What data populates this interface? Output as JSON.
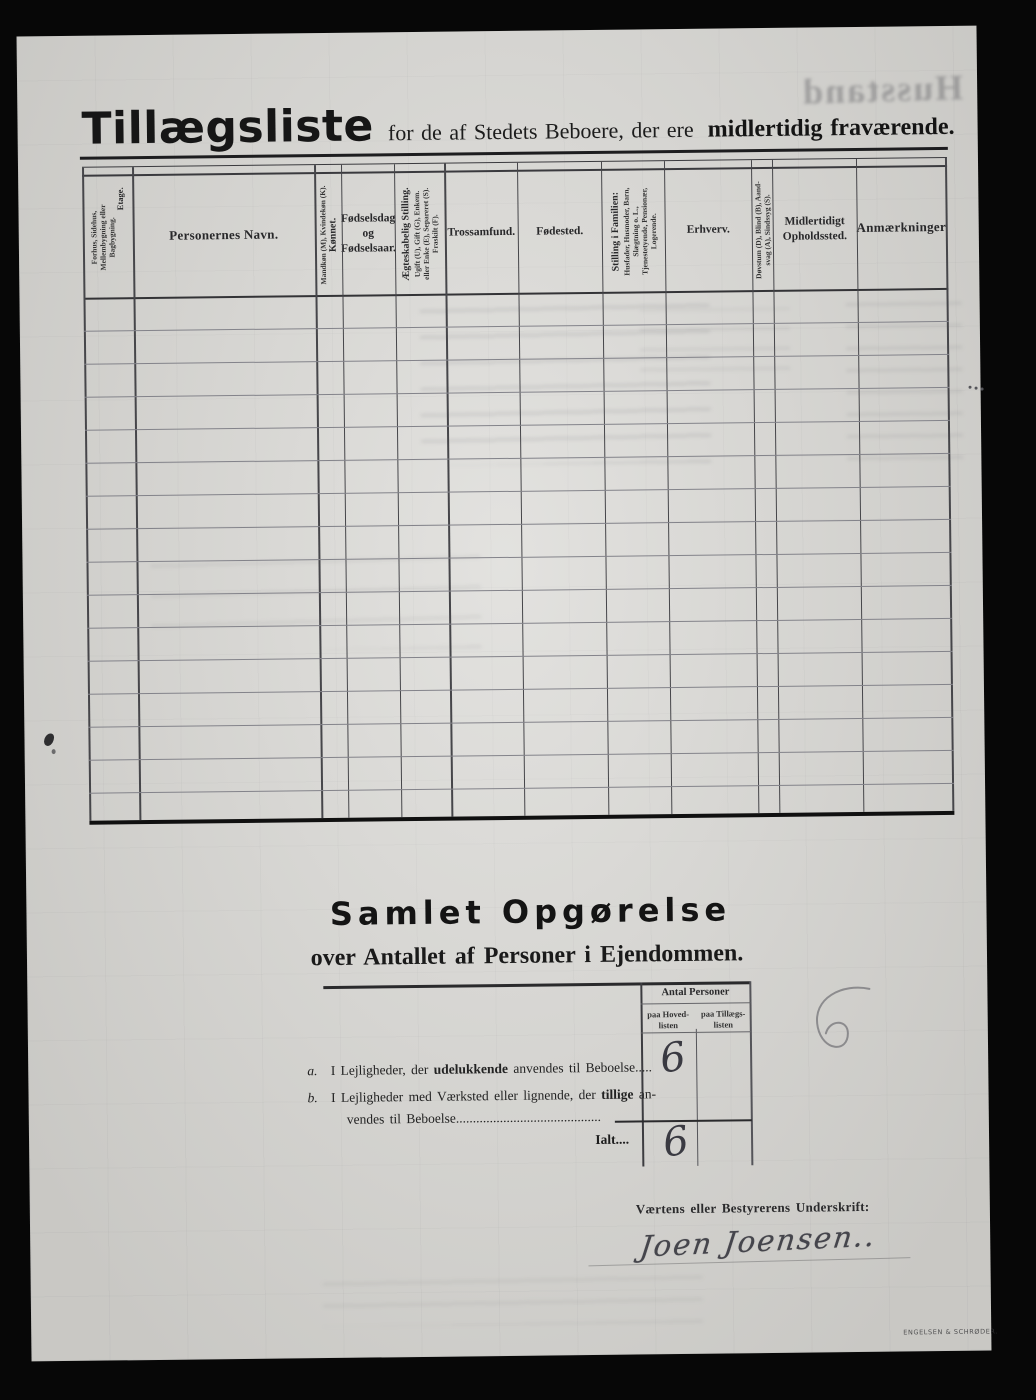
{
  "page": {
    "title_main": "Tillægsliste",
    "title_mid": "for de af Stedets Beboere, der ere",
    "title_bold": "midlertidig fraværende."
  },
  "table": {
    "body_rows": 16,
    "columns": [
      {
        "sub": "Forhus, Sidehus,\nMellembygning eller\nBagbygning.",
        "title": "Etage."
      },
      {
        "label": "Personernes Navn."
      },
      {
        "sub": "Mandkøn (M), Kvindekøn (K).",
        "title": "Kønnet."
      },
      {
        "label": "Fødselsdag\nog\nFødselsaar."
      },
      {
        "title": "Ægteskabelig Stilling.",
        "sub": "Ugift (U), Gift (G), Enkem.\neller Enke (E), Separeret (S).\nFraskilt (F)."
      },
      {
        "label": "Trossamfund."
      },
      {
        "label": "Fødested."
      },
      {
        "title": "Stilling i Familien:",
        "sub": "Husfader, Husmoder, Barn,\nSlægtning o. L.,\nTjenestetyende, Pensionær,\nLogerende."
      },
      {
        "label": "Erhverv."
      },
      {
        "sub": "Døvstum (D), Blind (B), Aand-\nsvag (A), Sindssyg (S)."
      },
      {
        "label": "Midlertidigt\nOpholdssted."
      },
      {
        "label": "Anmærkninger"
      }
    ]
  },
  "summary": {
    "title": "Samlet Opgørelse",
    "subtitle": "over Antallet af Personer i Ejendommen.",
    "count_header": "Antal Personer",
    "count_col1": "paa Hoved-\nlisten",
    "count_col2": "paa Tillægs-\nlisten",
    "row_a": {
      "prefix": "a.",
      "text1": "I Lejligheder, der",
      "bold": "udelukkende",
      "text2": "anvendes til Beboelse",
      "dots": ".....",
      "value_hoved": "6"
    },
    "row_b": {
      "prefix": "b.",
      "text1": "I Lejligheder med Værksted eller lignende, der",
      "bold": "tillige",
      "text2": "an-",
      "line2": "vendes til Beboelse",
      "dots": "..........................................."
    },
    "total": {
      "label": "Ialt",
      "dots": "....",
      "value_hoved": "6"
    }
  },
  "signature": {
    "label": "Værtens eller Bestyrerens Underskrift:",
    "name": "Joen Joensen.."
  },
  "footer": {
    "printer": "ENGELSEN & SCHRØDER."
  },
  "ghost": {
    "top_right": "Husstand"
  },
  "colors": {
    "paper": "#d8d7d3",
    "ink": "#1c1c1c",
    "line": "#46464a",
    "handwriting": "#3a3a42"
  }
}
